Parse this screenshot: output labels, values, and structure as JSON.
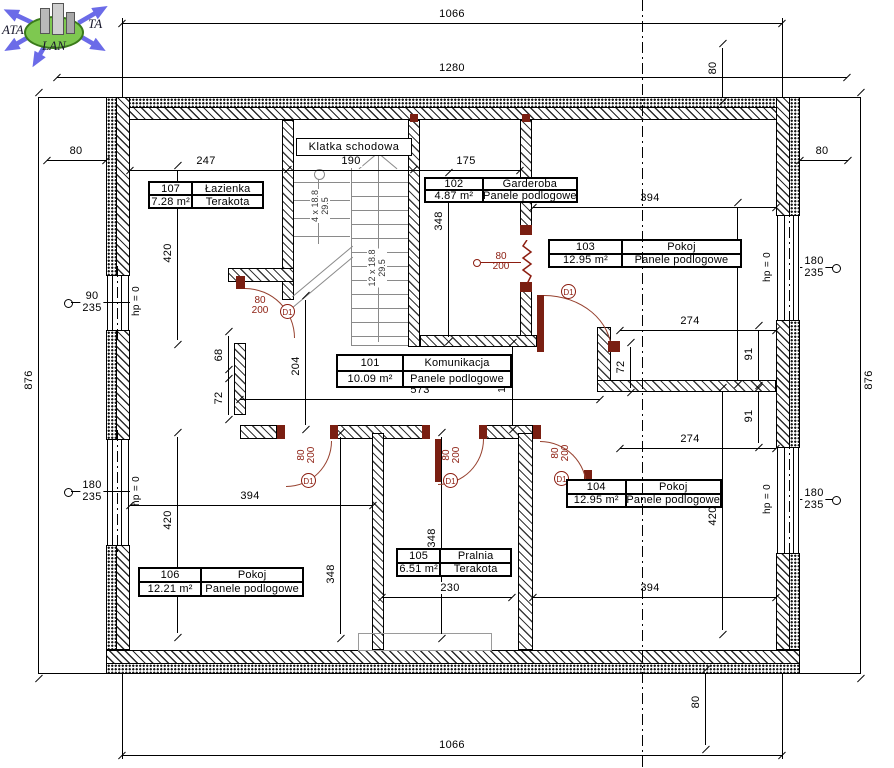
{
  "logo": {
    "text_left": "ATA",
    "text_right": "TA",
    "text_bottom": "LAN"
  },
  "stairwell_label": "Klatka schodowa",
  "rooms": [
    {
      "number": "107",
      "name": "Łazienka",
      "area": "7.28 m²",
      "floor": "Terakota"
    },
    {
      "number": "102",
      "name": "Garderoba",
      "area": "4.87 m²",
      "floor": "Panele podlogowe"
    },
    {
      "number": "103",
      "name": "Pokoj",
      "area": "12.95 m²",
      "floor": "Panele podlogowe"
    },
    {
      "number": "101",
      "name": "Komunikacja",
      "area": "10.09 m²",
      "floor": "Panele podlogowe"
    },
    {
      "number": "104",
      "name": "Pokoj",
      "area": "12.95 m²",
      "floor": "Panele podlogowe"
    },
    {
      "number": "105",
      "name": "Pralnia",
      "area": "6.51 m²",
      "floor": "Terakota"
    },
    {
      "number": "106",
      "name": "Pokoj",
      "area": "12.21 m²",
      "floor": "Panele podlogowe"
    }
  ],
  "stairs": {
    "short_flight": "4 x 18.8",
    "short_rise": "29.5",
    "long_flight": "12 x 18.8",
    "long_rise": "29.5"
  },
  "doors": {
    "size_w": "80",
    "size_h": "200",
    "tag": "D1"
  },
  "windows": {
    "sill": "hp = 0",
    "lt": {
      "w": "90",
      "h": "235"
    },
    "lb": {
      "w": "180",
      "h": "235"
    },
    "rt": {
      "w": "180",
      "h": "235"
    },
    "rb": {
      "w": "180",
      "h": "235"
    }
  },
  "dims": {
    "top_1066": "1066",
    "top_1280": "1280",
    "top_80": "80",
    "bottom_1066": "1066",
    "bottom_80": "80",
    "left_876": "876",
    "right_876": "876",
    "left_80": "80",
    "right_80": "80",
    "laz_w": "247",
    "stair_w": "190",
    "gard_w": "175",
    "laz_h": "420",
    "gard_h": "348",
    "r103_w": "394",
    "r103_h": "420",
    "hall_w": "204",
    "hall_l": "573",
    "vest_h": "132",
    "d68": "68",
    "d72l": "72",
    "d72r": "72",
    "d274t": "274",
    "d91t": "91",
    "d91b": "91",
    "d274b": "274",
    "r106_w": "394",
    "r106_h": "420",
    "r106_d": "348",
    "r105_d": "348",
    "r105_w": "230",
    "r104_w": "394",
    "r104_h": "420"
  },
  "colors": {
    "door_red": "#8c1d10",
    "logo_blue": "#6b6be8",
    "logo_green": "#7ec850",
    "stair_gray": "#8a8a8a"
  }
}
